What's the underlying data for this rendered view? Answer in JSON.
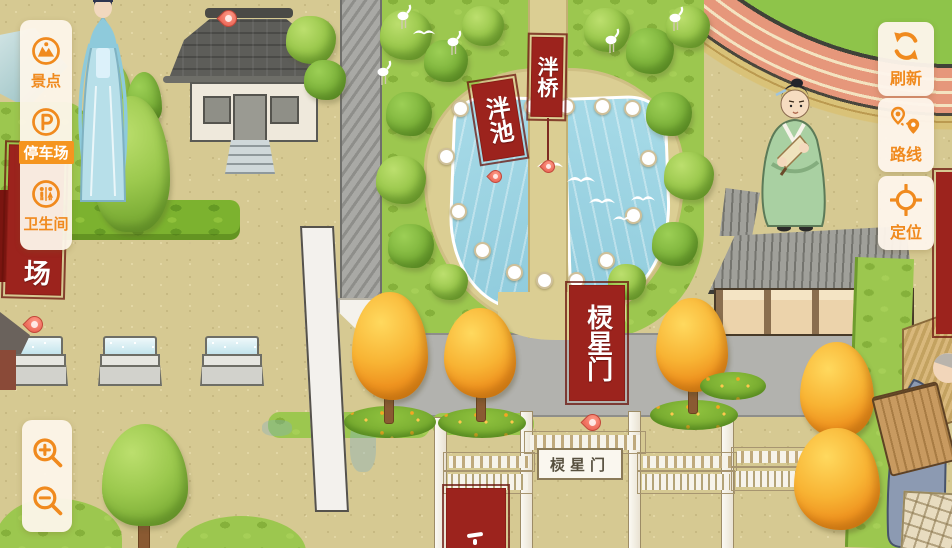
{
  "ui": {
    "accent_color": "#F08A1E",
    "panel_bg": "#FDF5EA",
    "left_panel": {
      "items": [
        {
          "label": "景点",
          "icon": "scenic-icon",
          "selected": false
        },
        {
          "label": "停车场",
          "icon": "parking-icon",
          "selected": true
        },
        {
          "label": "卫生间",
          "icon": "toilet-icon",
          "selected": false
        }
      ]
    },
    "right_buttons": [
      {
        "label": "刷新",
        "icon": "refresh-icon"
      },
      {
        "label": "路线",
        "icon": "route-icon"
      },
      {
        "label": "定位",
        "icon": "locate-icon"
      }
    ],
    "zoom_controls": [
      {
        "icon": "zoom-in-icon"
      },
      {
        "icon": "zoom-out-icon"
      }
    ]
  },
  "map": {
    "markers": {
      "pond": "泮池",
      "bridge": "泮桥",
      "gate": "棂星门",
      "partial": "场"
    },
    "gate_plaque": "棂星门",
    "colors": {
      "banner_red": "#9C231D",
      "ground": "#D6C992",
      "grass": "#9CC74F",
      "water": "#9AD2E2",
      "road": "#B2B2AE",
      "track": "#E6977B"
    }
  }
}
